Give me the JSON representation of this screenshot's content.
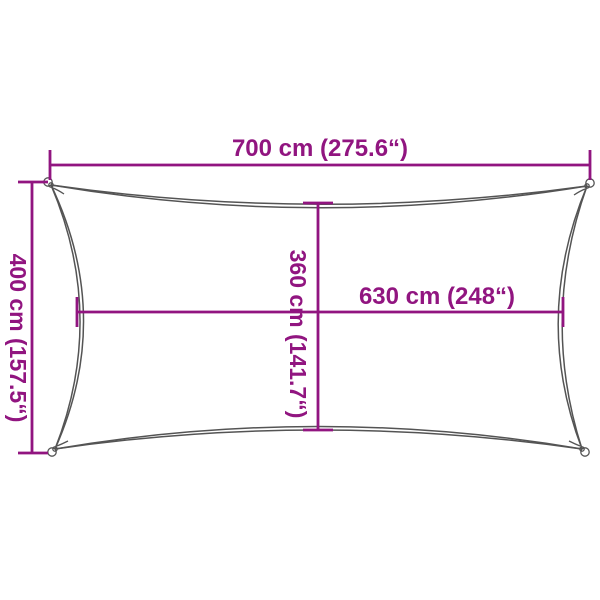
{
  "diagram": {
    "title": "shade-sail-dimension-diagram",
    "subject": "rectangular shade sail with concave edges and corner eyelets",
    "colors": {
      "dimension": "#911580",
      "outline": "#545454",
      "background": "#ffffff"
    },
    "dimensions": {
      "top_width": {
        "label": "700 cm (275.6“)"
      },
      "left_height": {
        "label": "400 cm (157.5“)"
      },
      "middle_vertical": {
        "label": "360 cm (141.7“)"
      },
      "middle_horizontal": {
        "label": "630 cm (248“)"
      }
    }
  }
}
